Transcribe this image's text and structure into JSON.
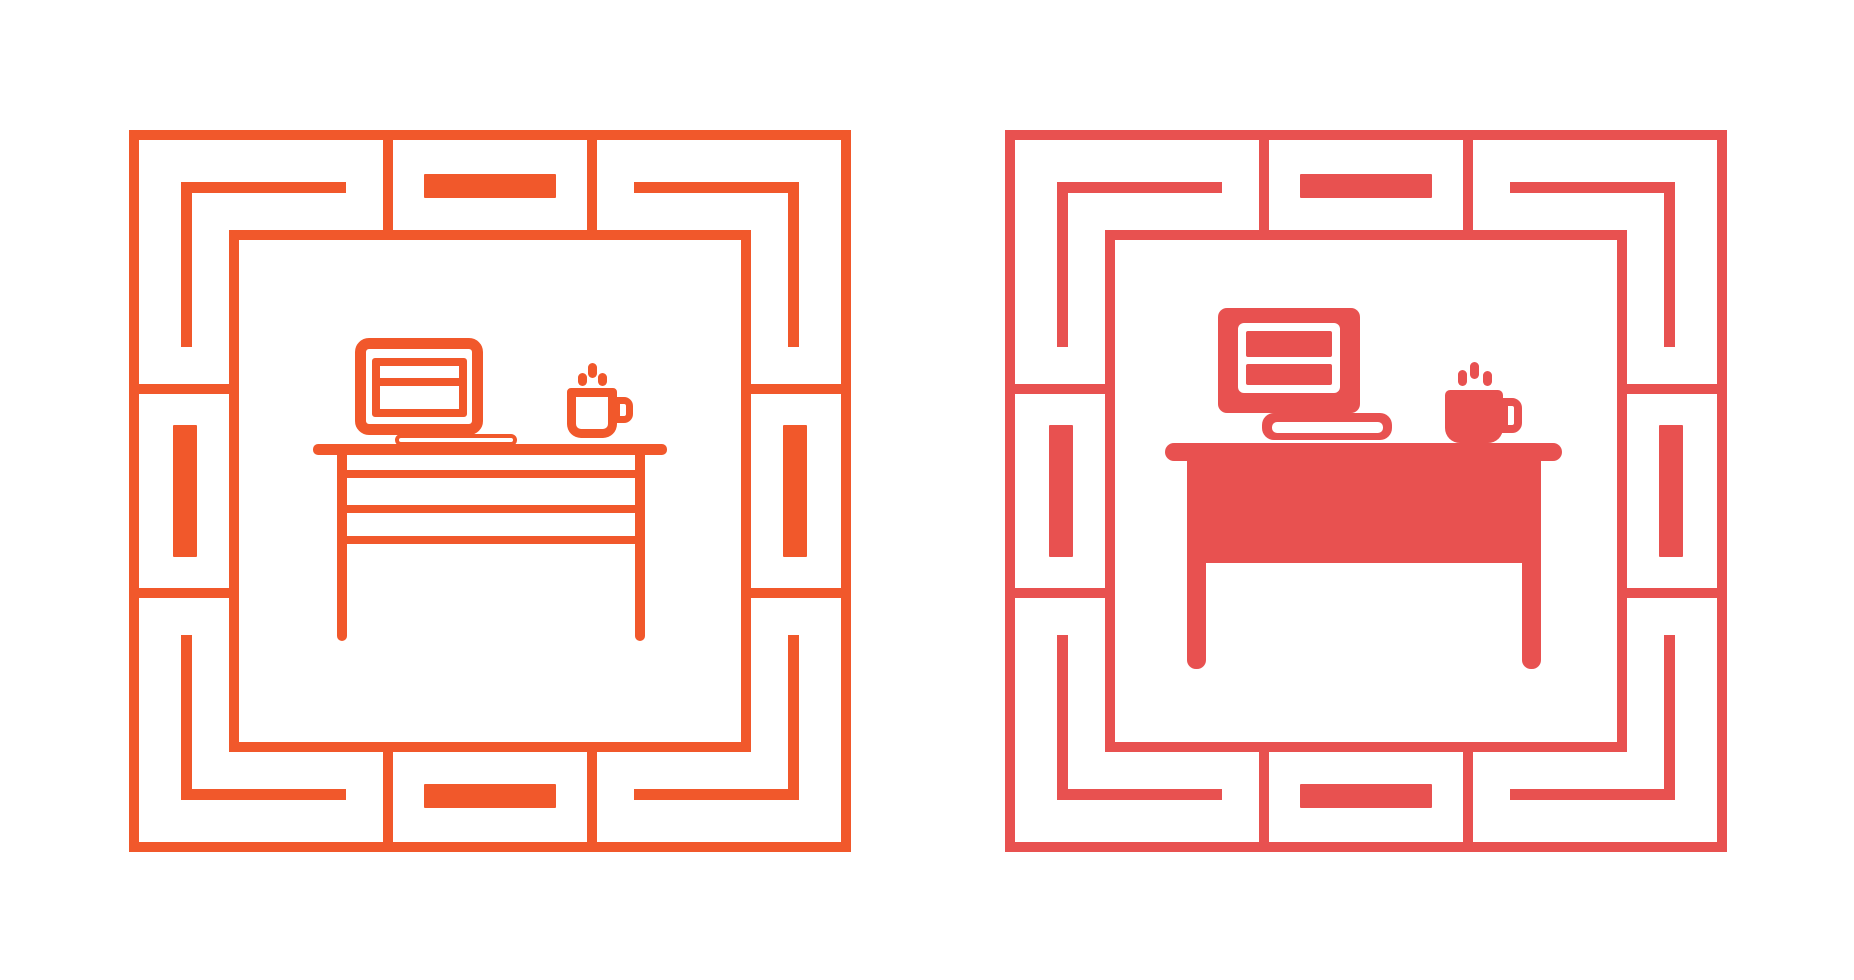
{
  "canvas": {
    "width": 1854,
    "height": 980,
    "background": "#ffffff"
  },
  "icons": [
    {
      "name": "workspace-desk-outline-icon",
      "style": "outline",
      "color": "#F1582B",
      "box": {
        "x": 129,
        "y": 130,
        "size": 722
      },
      "frame": {
        "shape": "square-in-square",
        "corner_decorations": "l-brackets",
        "edge_decorations": "filled-bars"
      },
      "elements": [
        "decorative-frame",
        "laptop",
        "laptop-base",
        "steaming-coffee-cup",
        "desk-with-drawers"
      ]
    },
    {
      "name": "workspace-desk-glyph-icon",
      "style": "filled",
      "color": "#E85150",
      "box": {
        "x": 1005,
        "y": 130,
        "size": 722
      },
      "frame": {
        "shape": "square-in-square",
        "corner_decorations": "l-brackets",
        "edge_decorations": "filled-bars"
      },
      "elements": [
        "decorative-frame",
        "monitor",
        "book",
        "steaming-coffee-cup",
        "solid-desk"
      ]
    }
  ]
}
